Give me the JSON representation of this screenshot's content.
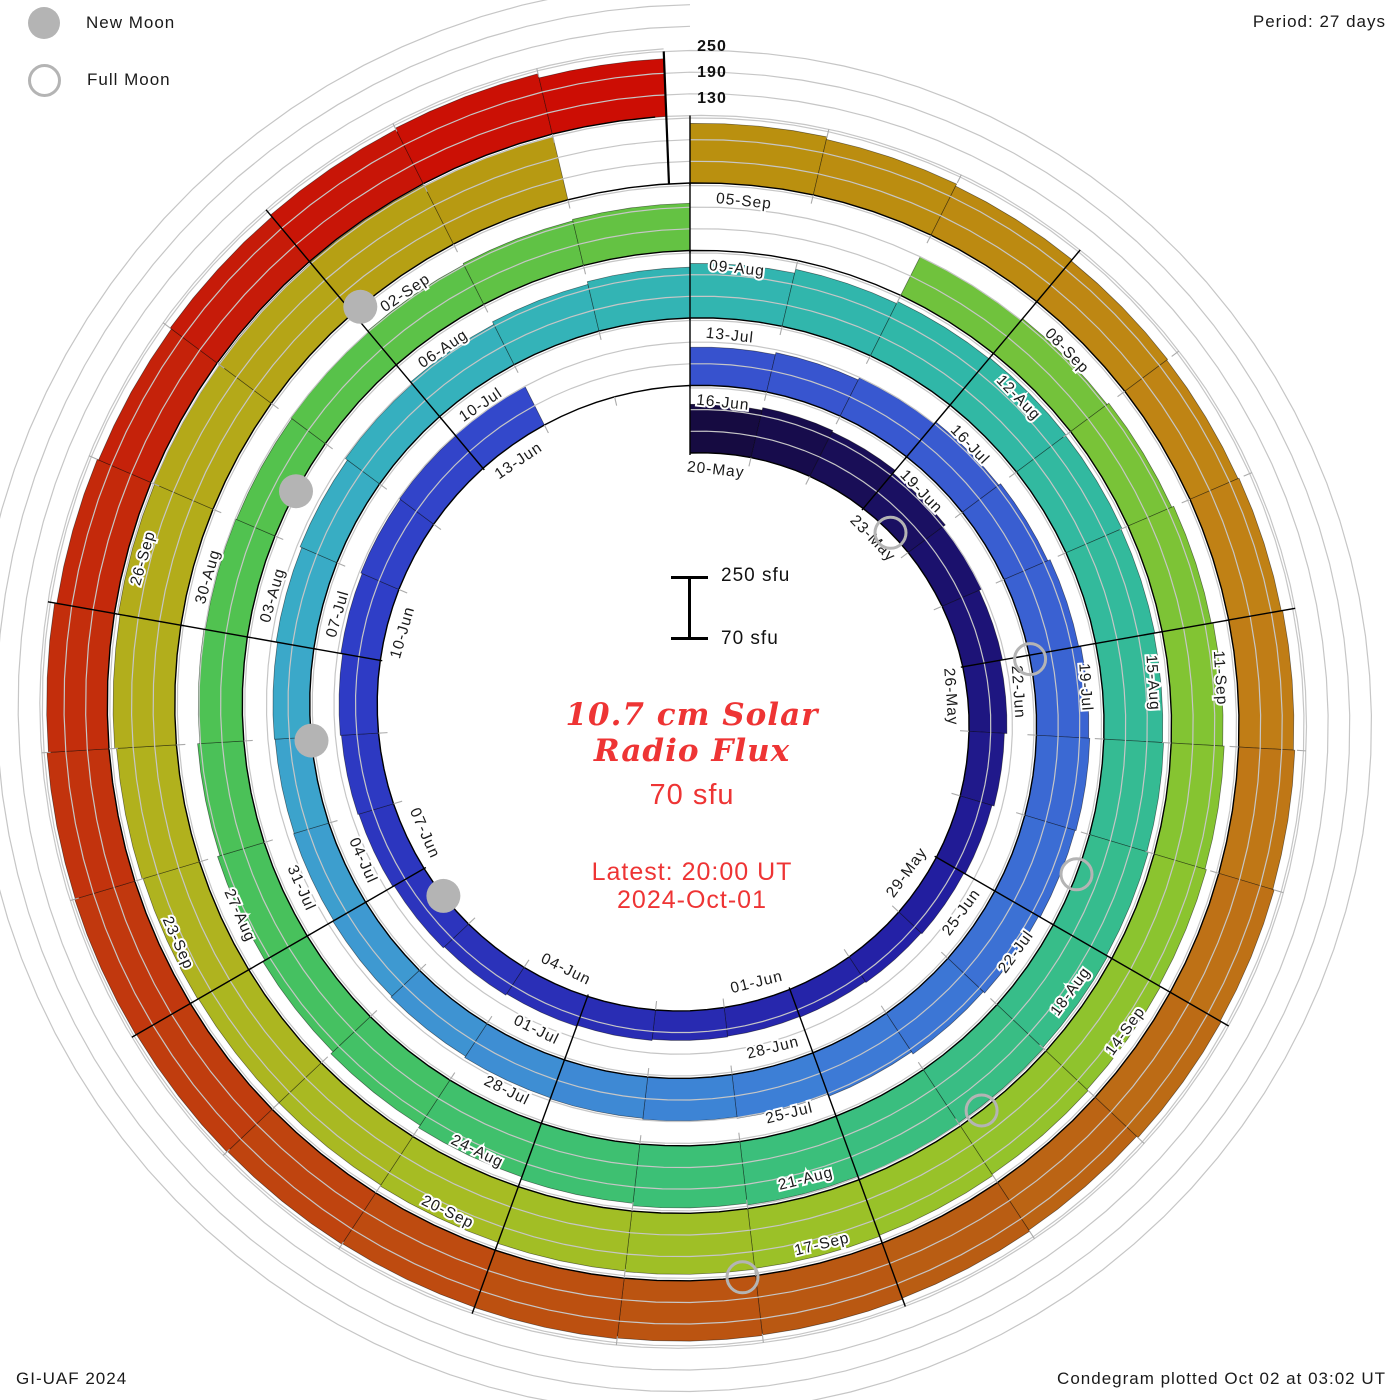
{
  "legend": {
    "new_moon": "New Moon",
    "full_moon": "Full Moon"
  },
  "header": {
    "period_label": "Period: 27 days"
  },
  "footer": {
    "left": "GI-UAF 2024",
    "right": "Condegram plotted Oct 02 at 03:02 UT"
  },
  "center": {
    "title_line1": "10.7 cm Solar",
    "title_line2": "Radio Flux",
    "current_value": "70 sfu",
    "latest_line": "Latest: 20:00 UT",
    "date_line": "2024-Oct-01"
  },
  "chart_data": {
    "type": "spiral-bar-condegram",
    "series_name": "10.7 cm Solar Radio Flux",
    "start_date_label": "20-May",
    "latest_label": "2024-Oct-01 20:00 UT",
    "period_days": 27,
    "rotations": 5,
    "days_per_tick": 1,
    "days_per_label": 3,
    "flux_base_sfu": 70,
    "flux_max_sfu": 250,
    "gridlines_sfu": [
      130,
      190,
      250
    ],
    "radial_axis_labels": [
      "250",
      "190",
      "130"
    ],
    "scale_bar": {
      "top_label": "250 sfu",
      "bottom_label": "70 sfu"
    },
    "end_day_fraction": 134.83,
    "flux": [
      205,
      212,
      208,
      198,
      190,
      182,
      175,
      168,
      162,
      158,
      155,
      152,
      150,
      152,
      155,
      158,
      162,
      166,
      170,
      173,
      176,
      181,
      185,
      188,
      190,
      null,
      null,
      176,
      182,
      189,
      196,
      202,
      209,
      215,
      218,
      215,
      210,
      205,
      198,
      192,
      188,
      185,
      182,
      178,
      175,
      172,
      170,
      172,
      176,
      181,
      188,
      195,
      203,
      211,
      221,
      232,
      238,
      241,
      239,
      236,
      233,
      236,
      240,
      244,
      247,
      249,
      247,
      242,
      235,
      228,
      220,
      212,
      205,
      198,
      192,
      188,
      186,
      189,
      193,
      197,
      201,
      null,
      null,
      190,
      196,
      202,
      208,
      213,
      217,
      221,
      226,
      230,
      234,
      237,
      239,
      237,
      234,
      231,
      231,
      233,
      236,
      241,
      246,
      249,
      252,
      254,
      251,
      null,
      235,
      228,
      222,
      218,
      215,
      218,
      222,
      226,
      230,
      233,
      228,
      232,
      235,
      237,
      239,
      238,
      240,
      242,
      244,
      242,
      238,
      232,
      228,
      232,
      238,
      242,
      230
    ],
    "labels": [
      {
        "d": 0,
        "text": "20-May"
      },
      {
        "d": 3,
        "text": "23-May"
      },
      {
        "d": 6,
        "text": "26-May"
      },
      {
        "d": 9,
        "text": "29-May"
      },
      {
        "d": 12,
        "text": "01-Jun"
      },
      {
        "d": 15,
        "text": "04-Jun"
      },
      {
        "d": 18,
        "text": "07-Jun"
      },
      {
        "d": 21,
        "text": "10-Jun"
      },
      {
        "d": 24,
        "text": "13-Jun"
      },
      {
        "d": 27,
        "text": "16-Jun"
      },
      {
        "d": 30,
        "text": "19-Jun"
      },
      {
        "d": 33,
        "text": "22-Jun"
      },
      {
        "d": 36,
        "text": "25-Jun"
      },
      {
        "d": 39,
        "text": "28-Jun"
      },
      {
        "d": 42,
        "text": "01-Jul"
      },
      {
        "d": 45,
        "text": "04-Jul"
      },
      {
        "d": 48,
        "text": "07-Jul"
      },
      {
        "d": 51,
        "text": "10-Jul"
      },
      {
        "d": 54,
        "text": "13-Jul"
      },
      {
        "d": 57,
        "text": "16-Jul"
      },
      {
        "d": 60,
        "text": "19-Jul"
      },
      {
        "d": 63,
        "text": "22-Jul"
      },
      {
        "d": 66,
        "text": "25-Jul"
      },
      {
        "d": 69,
        "text": "28-Jul"
      },
      {
        "d": 72,
        "text": "31-Jul"
      },
      {
        "d": 75,
        "text": "03-Aug"
      },
      {
        "d": 78,
        "text": "06-Aug"
      },
      {
        "d": 81,
        "text": "09-Aug"
      },
      {
        "d": 84,
        "text": "12-Aug"
      },
      {
        "d": 87,
        "text": "15-Aug"
      },
      {
        "d": 90,
        "text": "18-Aug"
      },
      {
        "d": 93,
        "text": "21-Aug"
      },
      {
        "d": 96,
        "text": "24-Aug"
      },
      {
        "d": 99,
        "text": "27-Aug"
      },
      {
        "d": 102,
        "text": "30-Aug"
      },
      {
        "d": 105,
        "text": "02-Sep"
      },
      {
        "d": 108,
        "text": "05-Sep"
      },
      {
        "d": 111,
        "text": "08-Sep"
      },
      {
        "d": 114,
        "text": "11-Sep"
      },
      {
        "d": 117,
        "text": "14-Sep"
      },
      {
        "d": 120,
        "text": "17-Sep"
      },
      {
        "d": 123,
        "text": "20-Sep"
      },
      {
        "d": 126,
        "text": "23-Sep"
      },
      {
        "d": 129,
        "text": "26-Sep"
      }
    ],
    "moons": [
      {
        "d": 3.58,
        "phase": "full"
      },
      {
        "d": 17.53,
        "phase": "new"
      },
      {
        "d": 33.05,
        "phase": "full"
      },
      {
        "d": 46.96,
        "phase": "new"
      },
      {
        "d": 62.43,
        "phase": "full"
      },
      {
        "d": 76.47,
        "phase": "new"
      },
      {
        "d": 91.77,
        "phase": "full"
      },
      {
        "d": 105.08,
        "phase": "new"
      },
      {
        "d": 121.1,
        "phase": "full"
      }
    ],
    "colormap": [
      [
        0,
        "#150a3c"
      ],
      [
        5,
        "#1c1272"
      ],
      [
        10,
        "#231fa4"
      ],
      [
        15,
        "#2a2eb6"
      ],
      [
        21,
        "#2e3cc6"
      ],
      [
        27,
        "#3750ce"
      ],
      [
        33,
        "#3a62d2"
      ],
      [
        39,
        "#3d7cd6"
      ],
      [
        44,
        "#3e96d2"
      ],
      [
        48,
        "#3aaac8"
      ],
      [
        52,
        "#34b2ba"
      ],
      [
        56,
        "#30b6aa"
      ],
      [
        60,
        "#33ba9a"
      ],
      [
        64,
        "#38bd86"
      ],
      [
        68,
        "#3dc074"
      ],
      [
        72,
        "#46c15e"
      ],
      [
        76,
        "#52c24e"
      ],
      [
        80,
        "#62c244"
      ],
      [
        84,
        "#72c23c"
      ],
      [
        88,
        "#84c432"
      ],
      [
        92,
        "#96c32a"
      ],
      [
        96,
        "#a4bd24"
      ],
      [
        100,
        "#b0b21e"
      ],
      [
        104,
        "#b4a818"
      ],
      [
        108,
        "#b9920e"
      ],
      [
        111,
        "#bd8812"
      ],
      [
        114,
        "#c08016"
      ],
      [
        117,
        "#bd6e16"
      ],
      [
        120,
        "#b85a12"
      ],
      [
        123,
        "#bd4e10"
      ],
      [
        126,
        "#c03a0e"
      ],
      [
        129,
        "#c32c0c"
      ],
      [
        132,
        "#c61808"
      ],
      [
        134,
        "#cc0d04"
      ]
    ],
    "colors": {
      "grid": "#c6c6c6",
      "baseline": "#000000",
      "separator": "#000000",
      "tick": "#aaaaaa",
      "moon_gray": "#b4b4b4",
      "label_text": "#1a1a1a",
      "accent_red": "#ee3434"
    }
  }
}
